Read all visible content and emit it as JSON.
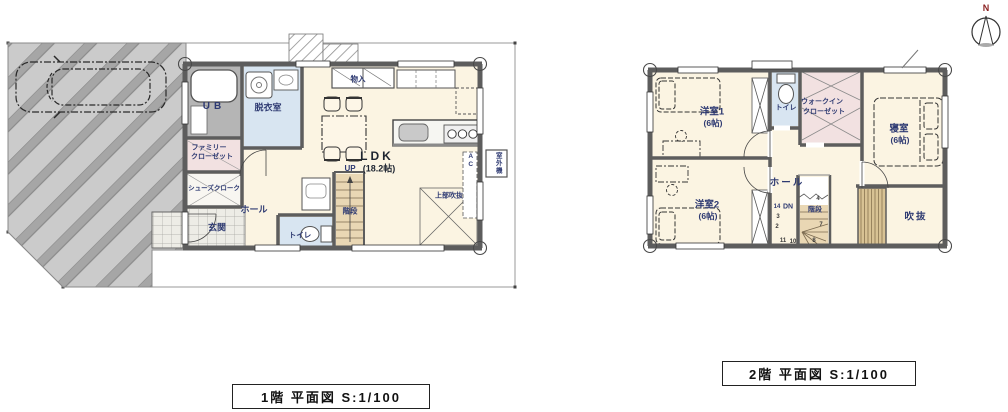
{
  "compass": {
    "north": "N"
  },
  "colors": {
    "floor_cream": "#fbf4e2",
    "water_blue": "#d8e5f1",
    "closet_pink": "#f2e1e1",
    "stair_tan": "#e9d7b4",
    "ub_gray": "#b5b5b5",
    "wall_gray": "#5d5d5d",
    "driveway_gray": "#c9c9c9",
    "slat_wood": "#d8c294",
    "label_navy": "#2e3a72",
    "north_red": "#8b2222"
  },
  "floor1": {
    "caption": "1階 平面図 S:1/100",
    "rooms": {
      "ub": "UB",
      "dressing_room": "脱衣室",
      "family_closet_line1": "ファミリー",
      "family_closet_line2": "クローゼット",
      "shoe_closet": "シューズクローク",
      "entrance": "玄関",
      "hall": "ホール",
      "toilet": "トイレ",
      "stairs": "階段",
      "ldk_line1": "LDK",
      "ldk_line2": "(18.2帖)",
      "storage": "物入",
      "open_ceiling_above": "上部吹抜",
      "ac_unit": "AC",
      "outdoor_unit": "室外機"
    },
    "annotations": {
      "up": "UP"
    }
  },
  "floor2": {
    "caption": "2階 平面図 S:1/100",
    "rooms": {
      "western_room1_line1": "洋室1",
      "western_room1_line2": "(6帖)",
      "western_room2_line1": "洋室2",
      "western_room2_line2": "(6帖)",
      "toilet": "トイレ",
      "walkin_closet_line1": "ウォークイン",
      "walkin_closet_line2": "クローゼット",
      "bedroom_line1": "寝室",
      "bedroom_line2": "(6帖)",
      "hall": "ホール",
      "stairs": "階段",
      "open_ceiling": "吹抜"
    },
    "annotations": {
      "down": "DN",
      "down_step": "14",
      "step_numbers": [
        "3",
        "2",
        "11",
        "10",
        "8",
        "7",
        "4"
      ]
    }
  }
}
